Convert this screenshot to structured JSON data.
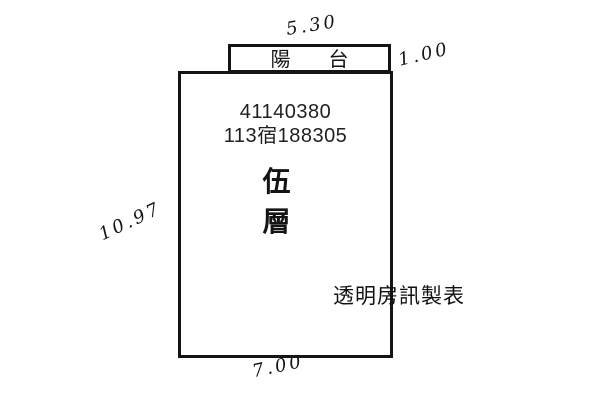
{
  "colors": {
    "line": "#141414",
    "text": "#1f1f1f",
    "background": "#ffffff"
  },
  "plan": {
    "balcony": {
      "label": "陽台",
      "label_chars": [
        "陽",
        "台"
      ]
    },
    "unit": {
      "building_number": "41140380",
      "registration_number": "113宿188305",
      "floor": "伍層",
      "floor_chars": [
        "伍",
        "層"
      ]
    },
    "dimensions": {
      "top": "5.30",
      "right": "1.00",
      "left": "10.97",
      "bottom": "7.00"
    }
  },
  "footer": {
    "maker_label": "透明房訊製表"
  }
}
